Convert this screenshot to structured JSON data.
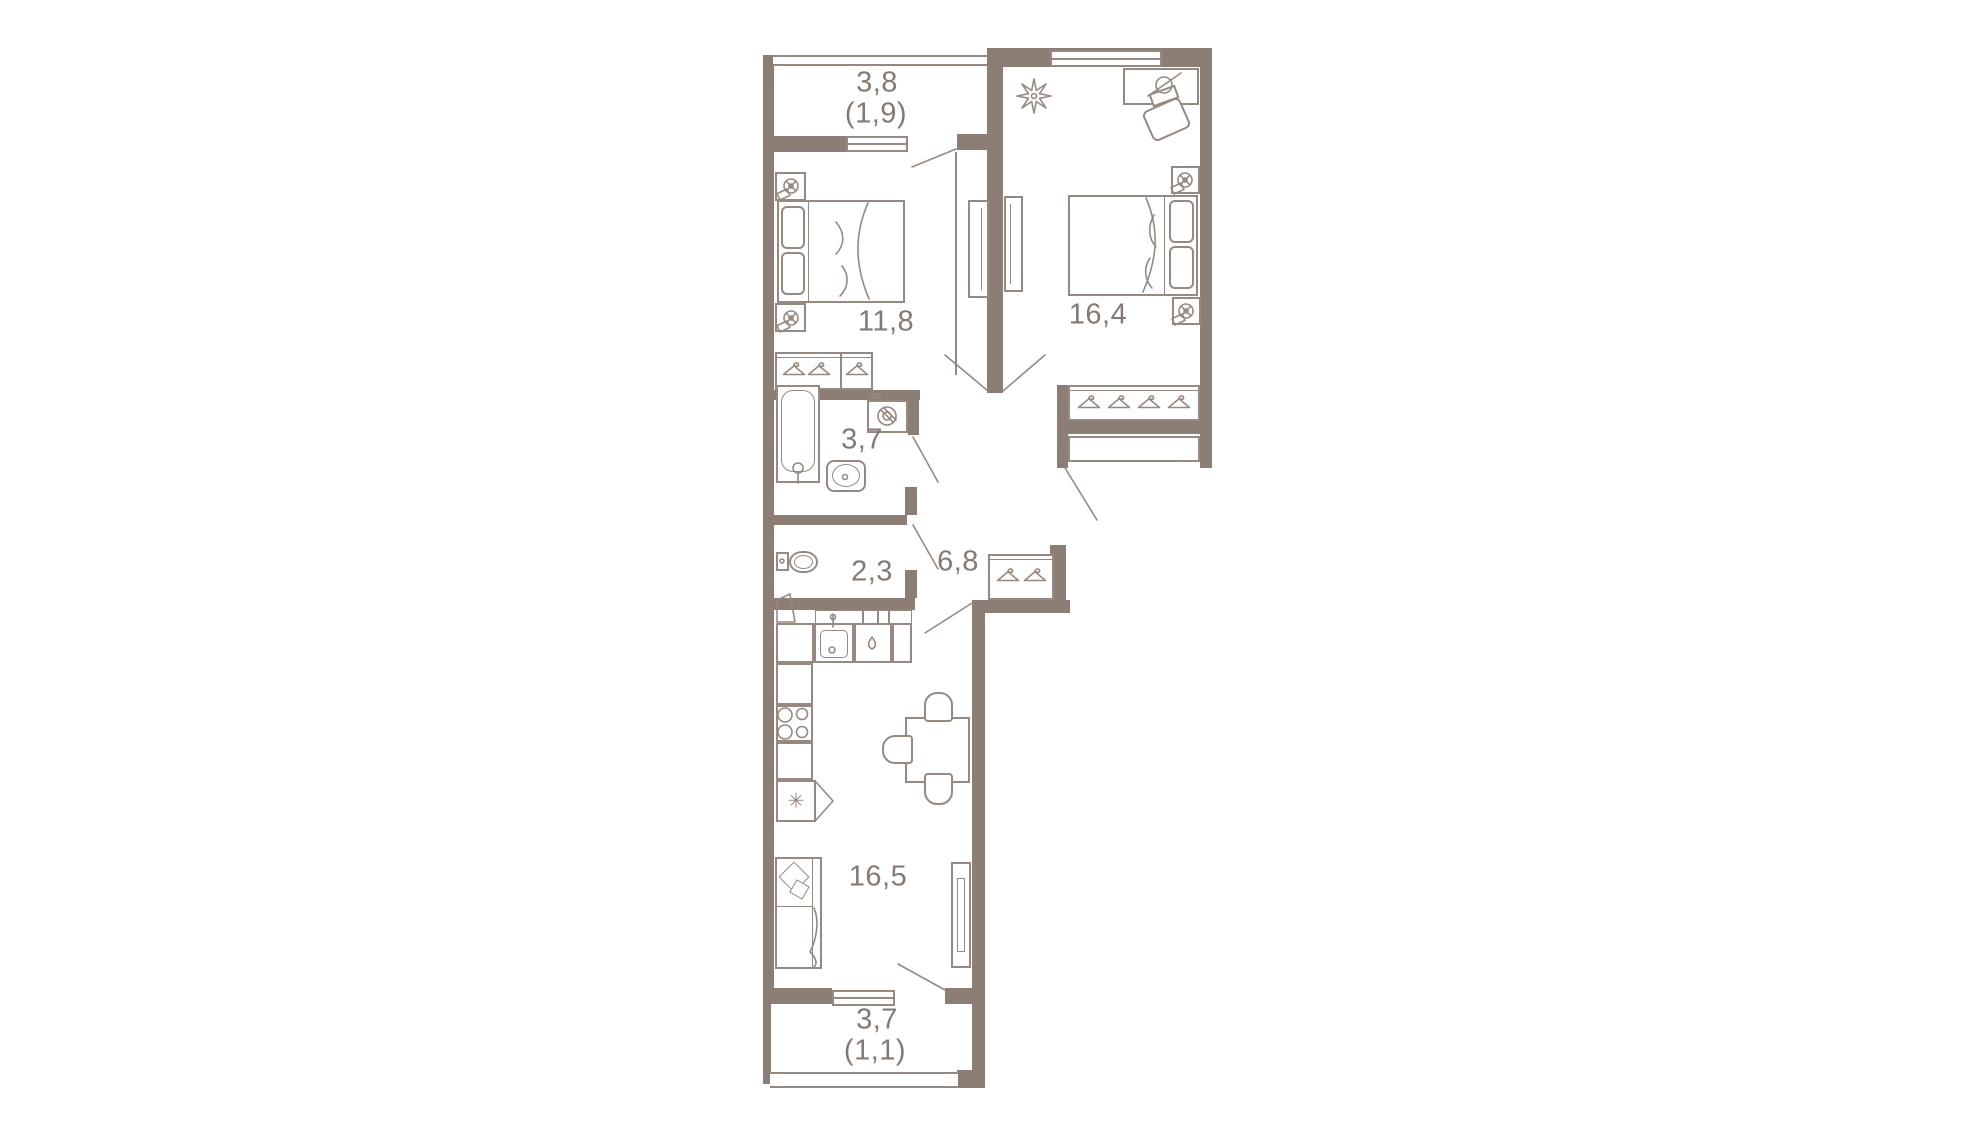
{
  "rooms": {
    "balcony_top": {
      "area": "3,8",
      "secondary": "(1,9)"
    },
    "bedroom_small": {
      "area": "11,8"
    },
    "bedroom_large": {
      "area": "16,4"
    },
    "bathroom": {
      "area": "3,7"
    },
    "wc": {
      "area": "2,3"
    },
    "hallway": {
      "area": "6,8"
    },
    "kitchen_living": {
      "area": "16,5"
    },
    "balcony_bottom": {
      "area": "3,7",
      "secondary": "(1,1)"
    }
  },
  "icons": {
    "snowflake": "✳",
    "hanger": "clothes-hanger",
    "wall_lamp": "circled-cross lamp",
    "plant": "eight-point star plant",
    "droplet": "water-drop"
  },
  "colors": {
    "wall": "#8C7E75",
    "line": "#97897F",
    "text": "#867970",
    "background": "#FFFFFF"
  }
}
